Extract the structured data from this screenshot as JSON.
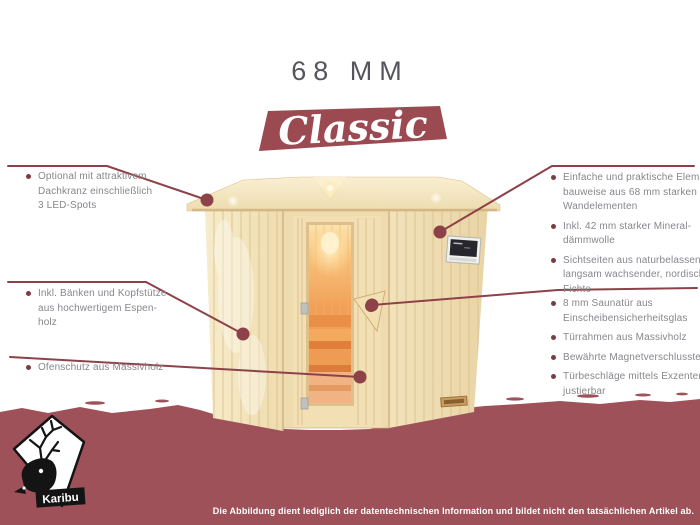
{
  "title": "68 MM",
  "series_badge": "Classic",
  "callouts": {
    "left": [
      {
        "text": "Optional mit attraktivem\nDachkranz einschließlich\n3 LED-Spots"
      },
      {
        "text": "Inkl. Bänken und Kopfstütze\naus hochwertigem Espen-\nholz"
      },
      {
        "text": "Ofenschutz aus Massivholz"
      }
    ],
    "right_top": [
      {
        "text": "Einfache und praktische Element-\nbauweise aus 68 mm starken\nWandelementen"
      },
      {
        "text": "Inkl. 42 mm starker Mineral-\ndämmwolle"
      },
      {
        "text": "Sichtseiten aus naturbelassener,\nlangsam wachsender, nordischer\nFichte"
      }
    ],
    "right_bottom": [
      {
        "text": "8 mm Saunatür aus\nEinscheibensicherheitsglas"
      },
      {
        "text": "Türrahmen aus Massivholz"
      },
      {
        "text": "Bewährte Magnetverschlusstechnik"
      },
      {
        "text": "Türbeschläge mittels Exzenter\njustierbar"
      }
    ]
  },
  "footer": {
    "disclaimer": "Die Abbildung dient lediglich der datentechnischen Information und bildet nicht den tatsächlichen Artikel ab.",
    "logo_text": "Karibu"
  },
  "colors": {
    "accent_maroon": "#9c4a52",
    "banner": "#9e5159",
    "callout_line": "#8d4149",
    "body_text": "#87878c",
    "title_text": "#55555d",
    "wood_light": "#f3e5c0",
    "glass_glow": "#f5a35c"
  }
}
